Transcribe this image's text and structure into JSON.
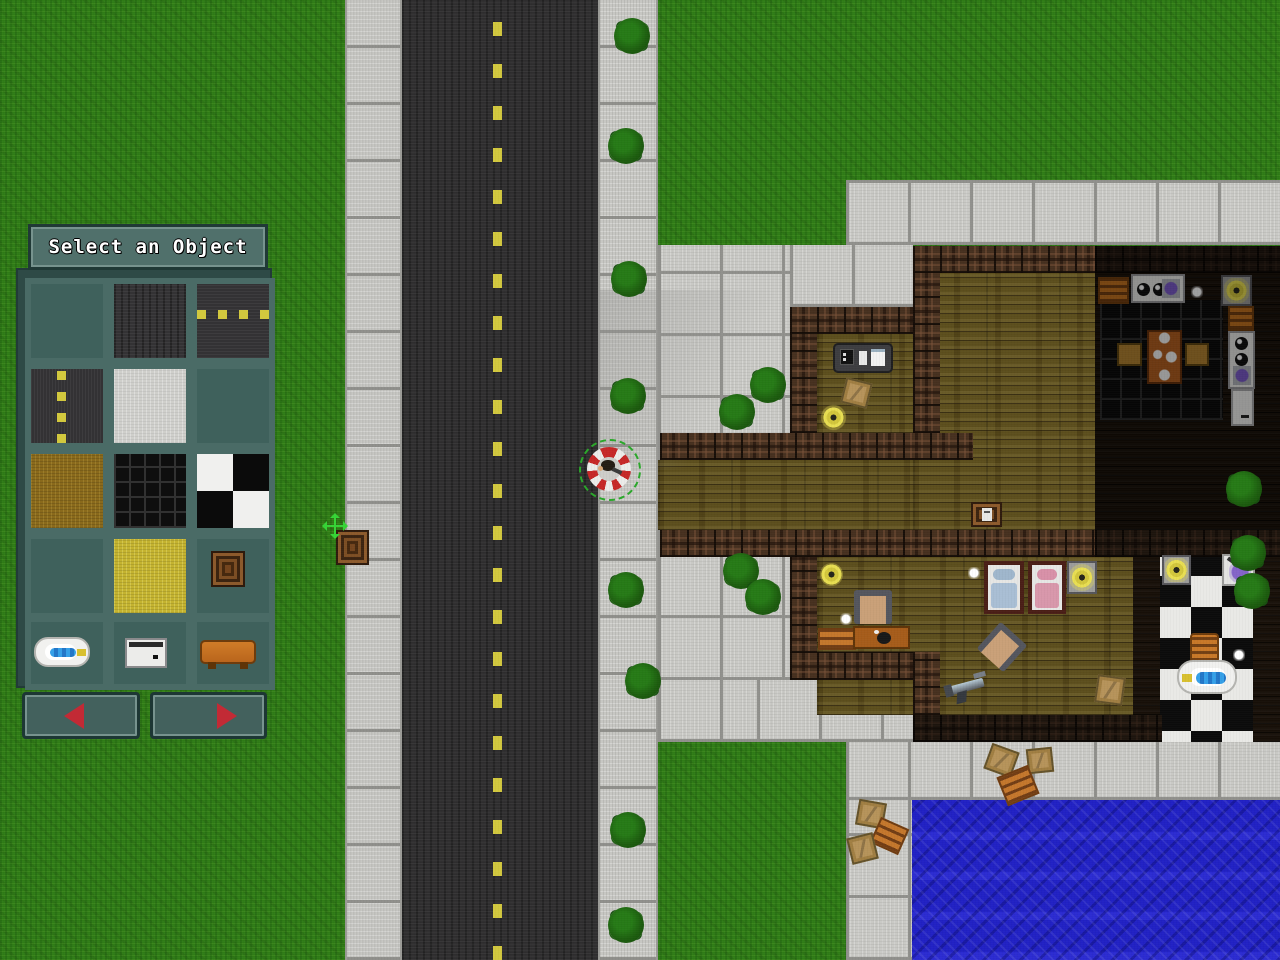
{
  "panel": {
    "title": "Select an Object",
    "tiles": [
      {
        "name": "grass"
      },
      {
        "name": "asphalt"
      },
      {
        "name": "road-horizontal"
      },
      {
        "name": "road-vertical"
      },
      {
        "name": "concrete"
      },
      {
        "name": "wood-planks"
      },
      {
        "name": "dirt"
      },
      {
        "name": "dark-tile"
      },
      {
        "name": "checker-tile"
      },
      {
        "name": "water"
      },
      {
        "name": "sand"
      },
      {
        "name": "crate"
      },
      {
        "name": "bathtub"
      },
      {
        "name": "stove"
      },
      {
        "name": "bench"
      }
    ],
    "nav": {
      "prev_icon": "left-arrow",
      "next_icon": "right-arrow"
    }
  },
  "colors": {
    "panel_frame": "#4a6b66",
    "panel_bg": "#2e4a46",
    "arrow_red": "#c22a35",
    "ring_red": "#c62828",
    "ring_green": "#2aa82a",
    "road_line_yellow": "#d2c83e",
    "cursor_green": "#35d435"
  },
  "scene": {
    "regions": [
      {
        "type": "grass",
        "x": 0,
        "y": 0,
        "w": 1280,
        "h": 960
      },
      {
        "type": "sidewalk",
        "x": 345,
        "y": 0,
        "w": 57,
        "h": 960
      },
      {
        "type": "road",
        "x": 402,
        "y": 0,
        "w": 196,
        "h": 960
      },
      {
        "type": "road-line",
        "x": 493,
        "y": 0,
        "w": 9,
        "h": 960
      },
      {
        "type": "sidewalk",
        "x": 598,
        "y": 0,
        "w": 60,
        "h": 960
      },
      {
        "type": "concrete",
        "x": 846,
        "y": 180,
        "w": 434,
        "h": 65
      },
      {
        "type": "concrete",
        "x": 658,
        "y": 245,
        "w": 132,
        "h": 215
      },
      {
        "type": "concrete",
        "x": 790,
        "y": 245,
        "w": 123,
        "h": 62
      },
      {
        "type": "concrete",
        "x": 658,
        "y": 530,
        "w": 132,
        "h": 212
      },
      {
        "type": "concrete",
        "x": 757,
        "y": 680,
        "w": 183,
        "h": 62
      },
      {
        "type": "concrete",
        "x": 846,
        "y": 742,
        "w": 434,
        "h": 58
      },
      {
        "type": "concrete",
        "x": 846,
        "y": 800,
        "w": 66,
        "h": 160
      },
      {
        "type": "water",
        "x": 912,
        "y": 800,
        "w": 368,
        "h": 160
      },
      {
        "type": "wood",
        "x": 817,
        "y": 334,
        "w": 96,
        "h": 99
      },
      {
        "type": "wood",
        "x": 658,
        "y": 460,
        "w": 255,
        "h": 70
      },
      {
        "type": "wood",
        "x": 913,
        "y": 273,
        "w": 367,
        "h": 257
      },
      {
        "type": "wood",
        "x": 817,
        "y": 557,
        "w": 376,
        "h": 158
      },
      {
        "type": "dark-floor",
        "x": 1095,
        "y": 273,
        "w": 185,
        "h": 257
      },
      {
        "type": "kitchen-grid",
        "x": 1100,
        "y": 300,
        "w": 123,
        "h": 120
      },
      {
        "type": "dark-floor",
        "x": 1133,
        "y": 557,
        "w": 27,
        "h": 185
      },
      {
        "type": "checker",
        "x": 1160,
        "y": 545,
        "w": 93,
        "h": 197
      },
      {
        "type": "dark-floor",
        "x": 1253,
        "y": 545,
        "w": 27,
        "h": 197
      },
      {
        "type": "shade",
        "x": 598,
        "y": 290,
        "w": 200,
        "h": 180
      }
    ],
    "walls": [
      {
        "x": 913,
        "y": 246,
        "w": 182,
        "h": 27
      },
      {
        "x": 1095,
        "y": 246,
        "w": 185,
        "h": 27,
        "dark": true
      },
      {
        "x": 913,
        "y": 273,
        "w": 27,
        "h": 160
      },
      {
        "x": 790,
        "y": 307,
        "w": 123,
        "h": 27
      },
      {
        "x": 790,
        "y": 334,
        "w": 27,
        "h": 126
      },
      {
        "x": 660,
        "y": 433,
        "w": 313,
        "h": 27
      },
      {
        "x": 660,
        "y": 530,
        "w": 435,
        "h": 27
      },
      {
        "x": 1095,
        "y": 530,
        "w": 185,
        "h": 27,
        "dark": true
      },
      {
        "x": 790,
        "y": 557,
        "w": 27,
        "h": 123
      },
      {
        "x": 790,
        "y": 652,
        "w": 150,
        "h": 28
      },
      {
        "x": 913,
        "y": 652,
        "w": 27,
        "h": 90
      },
      {
        "x": 913,
        "y": 715,
        "w": 249,
        "h": 27,
        "dark": true
      }
    ],
    "objects": [
      {
        "type": "tv-unit",
        "x": 833,
        "y": 343,
        "w": 60,
        "h": 30
      },
      {
        "type": "crate-tan",
        "x": 843,
        "y": 380,
        "w": 27,
        "h": 26,
        "rot": 14
      },
      {
        "type": "lamp",
        "x": 820,
        "y": 404,
        "w": 27,
        "h": 27
      },
      {
        "type": "crate-labeled",
        "x": 971,
        "y": 502,
        "w": 31,
        "h": 25
      },
      {
        "type": "lamp",
        "x": 820,
        "y": 563,
        "w": 23,
        "h": 23
      },
      {
        "type": "white-dot",
        "x": 968,
        "y": 567,
        "w": 12,
        "h": 12
      },
      {
        "type": "chair",
        "x": 854,
        "y": 590,
        "w": 38,
        "h": 34
      },
      {
        "type": "white-dot",
        "x": 840,
        "y": 613,
        "w": 12,
        "h": 12
      },
      {
        "type": "pallet",
        "x": 818,
        "y": 628,
        "w": 38,
        "h": 22
      },
      {
        "type": "desk",
        "x": 853,
        "y": 626,
        "w": 57,
        "h": 23
      },
      {
        "type": "bed-blue",
        "x": 984,
        "y": 561,
        "w": 40,
        "h": 53
      },
      {
        "type": "bed-pink",
        "x": 1028,
        "y": 561,
        "w": 38,
        "h": 53
      },
      {
        "type": "lamp-plate",
        "x": 1067,
        "y": 561,
        "w": 30,
        "h": 33
      },
      {
        "type": "chair",
        "x": 984,
        "y": 629,
        "w": 36,
        "h": 36,
        "rot": 42
      },
      {
        "type": "gun",
        "x": 944,
        "y": 664,
        "w": 46,
        "h": 44,
        "rot": -15
      },
      {
        "type": "crate-tan",
        "x": 1096,
        "y": 676,
        "w": 28,
        "h": 28,
        "rot": 8
      },
      {
        "type": "shelf",
        "x": 1098,
        "y": 277,
        "w": 31,
        "h": 27
      },
      {
        "type": "stove-top",
        "x": 1131,
        "y": 274,
        "w": 54,
        "h": 29
      },
      {
        "type": "white-dot",
        "x": 1191,
        "y": 286,
        "w": 12,
        "h": 12
      },
      {
        "type": "lamp-plate",
        "x": 1221,
        "y": 275,
        "w": 31,
        "h": 31
      },
      {
        "type": "shelf",
        "x": 1228,
        "y": 306,
        "w": 26,
        "h": 25
      },
      {
        "type": "stove-side",
        "x": 1228,
        "y": 331,
        "w": 27,
        "h": 58
      },
      {
        "type": "fridge",
        "x": 1231,
        "y": 389,
        "w": 23,
        "h": 37
      },
      {
        "type": "kitchen-table",
        "x": 1147,
        "y": 330,
        "w": 35,
        "h": 54
      },
      {
        "type": "kchair",
        "x": 1117,
        "y": 343,
        "w": 25,
        "h": 23
      },
      {
        "type": "kchair",
        "x": 1185,
        "y": 343,
        "w": 24,
        "h": 23
      },
      {
        "type": "lamp-plate",
        "x": 1162,
        "y": 555,
        "w": 29,
        "h": 30
      },
      {
        "type": "sink",
        "x": 1222,
        "y": 554,
        "w": 33,
        "h": 32
      },
      {
        "type": "basket",
        "x": 1190,
        "y": 633,
        "w": 29,
        "h": 30
      },
      {
        "type": "bathtub",
        "x": 1177,
        "y": 660,
        "w": 60,
        "h": 34
      },
      {
        "type": "white-dot",
        "x": 1233,
        "y": 649,
        "w": 12,
        "h": 12
      },
      {
        "type": "crate-wood",
        "x": 336,
        "y": 530,
        "w": 33,
        "h": 35
      },
      {
        "type": "move-cursor",
        "x": 321,
        "y": 512,
        "w": 28,
        "h": 28
      },
      {
        "type": "crate-tan",
        "x": 987,
        "y": 747,
        "w": 29,
        "h": 27,
        "rot": 20
      },
      {
        "type": "crate-tan",
        "x": 1027,
        "y": 748,
        "w": 26,
        "h": 25,
        "rot": -6
      },
      {
        "type": "pallet",
        "x": 1001,
        "y": 770,
        "w": 34,
        "h": 31,
        "rot": -22
      },
      {
        "type": "crate-tan",
        "x": 857,
        "y": 801,
        "w": 28,
        "h": 26,
        "rot": 10
      },
      {
        "type": "pallet",
        "x": 874,
        "y": 822,
        "w": 31,
        "h": 28,
        "rot": 24
      },
      {
        "type": "crate-tan",
        "x": 849,
        "y": 835,
        "w": 27,
        "h": 27,
        "rot": -14
      }
    ],
    "overlays": [
      {
        "x": 1095,
        "y": 246,
        "w": 185,
        "h": 284
      }
    ],
    "trees": [
      [
        632,
        36
      ],
      [
        626,
        146
      ],
      [
        629,
        279
      ],
      [
        628,
        396
      ],
      [
        626,
        590
      ],
      [
        643,
        681
      ],
      [
        628,
        830
      ],
      [
        626,
        925
      ],
      [
        768,
        385
      ],
      [
        737,
        412
      ],
      [
        741,
        571
      ],
      [
        763,
        597
      ],
      [
        1244,
        489
      ],
      [
        1248,
        553
      ],
      [
        1252,
        591
      ]
    ],
    "player": {
      "x": 609,
      "y": 469
    }
  }
}
